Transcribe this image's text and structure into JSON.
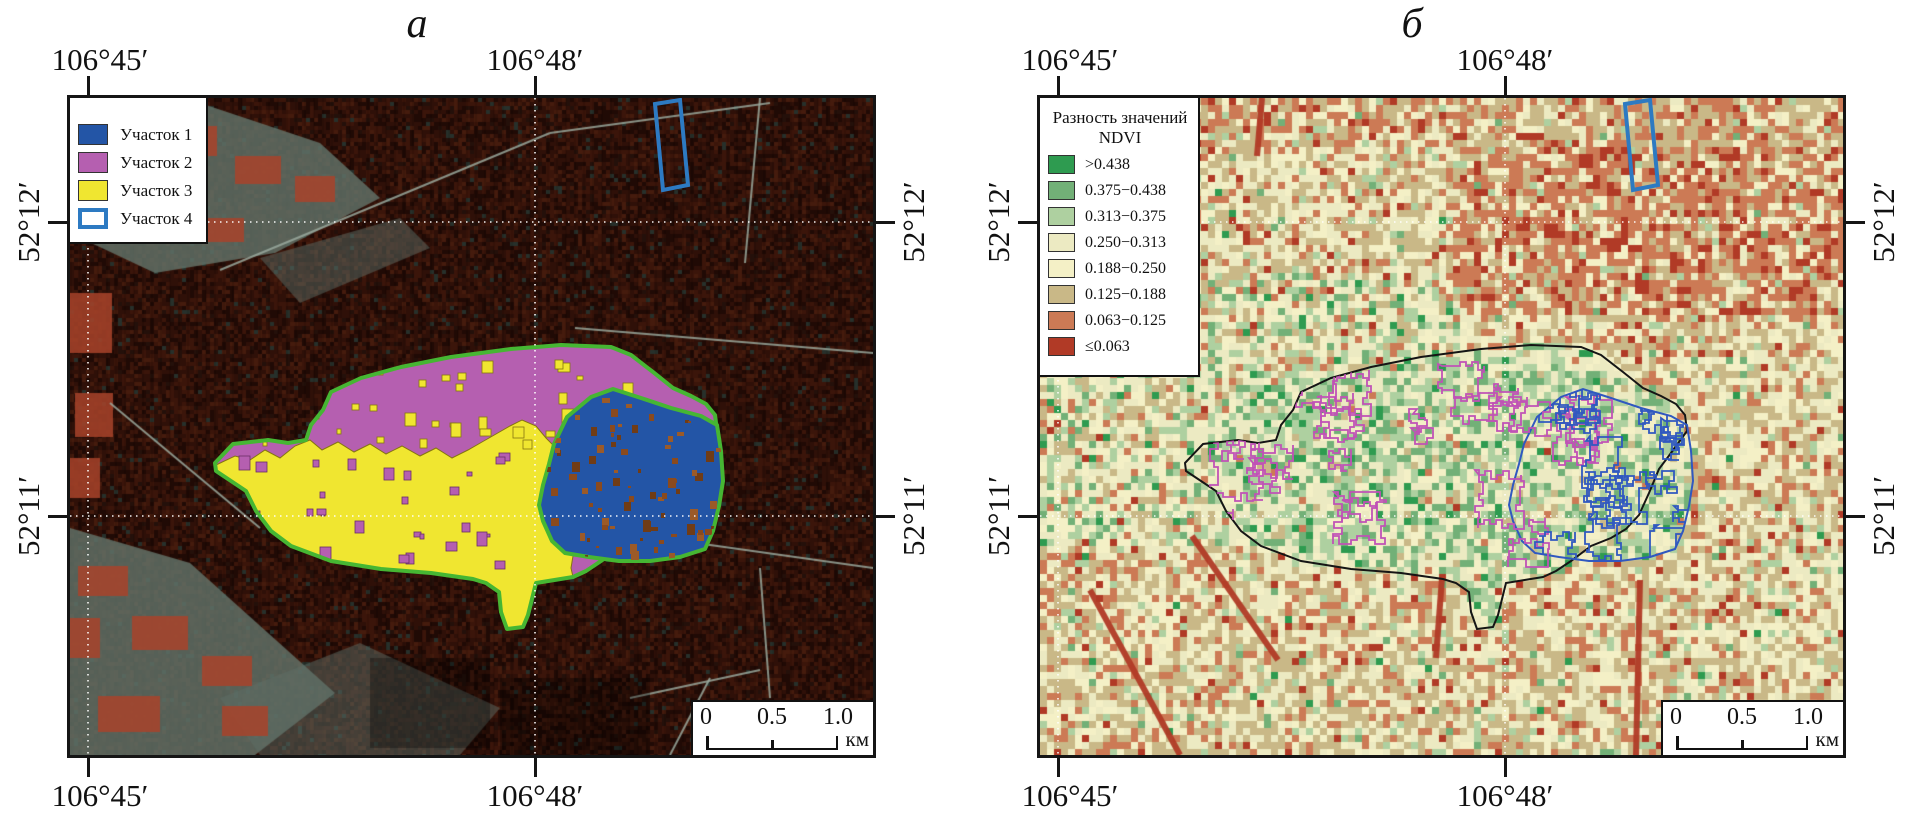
{
  "panel_a": {
    "title": "а",
    "axis": {
      "top": [
        "106°45′",
        "106°48′"
      ],
      "bottom": [
        "106°45′",
        "106°48′"
      ],
      "left": [
        "52°12′",
        "52°11′"
      ],
      "right": [
        "52°12′",
        "52°11′"
      ]
    },
    "legend": {
      "items": [
        {
          "label": "Участок 1",
          "color": "#2355a6",
          "style": "fill"
        },
        {
          "label": "Участок 2",
          "color": "#b55fb0",
          "style": "fill"
        },
        {
          "label": "Участок 3",
          "color": "#f0e630",
          "style": "fill"
        },
        {
          "label": "Участок 4",
          "color": "#2d7ac2",
          "style": "outline"
        }
      ]
    },
    "scalebar": {
      "ticks": [
        "0",
        "0.5",
        "1.0"
      ],
      "unit": "км"
    },
    "site_outline_color": "#46b633"
  },
  "panel_b": {
    "title": "б",
    "axis": {
      "top": [
        "106°45′",
        "106°48′"
      ],
      "bottom": [
        "106°45′",
        "106°48′"
      ],
      "left": [
        "52°12′",
        "52°11′"
      ],
      "right": [
        "52°12′",
        "52°11′"
      ]
    },
    "legend": {
      "title_line1": "Разность значений",
      "title_line2": "NDVI",
      "items": [
        {
          "label": ">0.438",
          "color": "#2e9b50"
        },
        {
          "label": "0.375−0.438",
          "color": "#72b077"
        },
        {
          "label": "0.313−0.375",
          "color": "#aed0a0"
        },
        {
          "label": "0.250−0.313",
          "color": "#eceac2"
        },
        {
          "label": "0.188−0.250",
          "color": "#f4f0c6"
        },
        {
          "label": "0.125−0.188",
          "color": "#c9b887"
        },
        {
          "label": "0.063−0.125",
          "color": "#cc7a55"
        },
        {
          "label": "≤0.063",
          "color": "#b13a26"
        }
      ]
    },
    "scalebar": {
      "ticks": [
        "0",
        "0.5",
        "1.0"
      ],
      "unit": "км"
    },
    "outline_colors": {
      "sites_1_2_3": "#151515",
      "clusters_left": "#c052b6",
      "clusters_right": "#3058c0",
      "site_4": "#2d7ac2"
    }
  }
}
